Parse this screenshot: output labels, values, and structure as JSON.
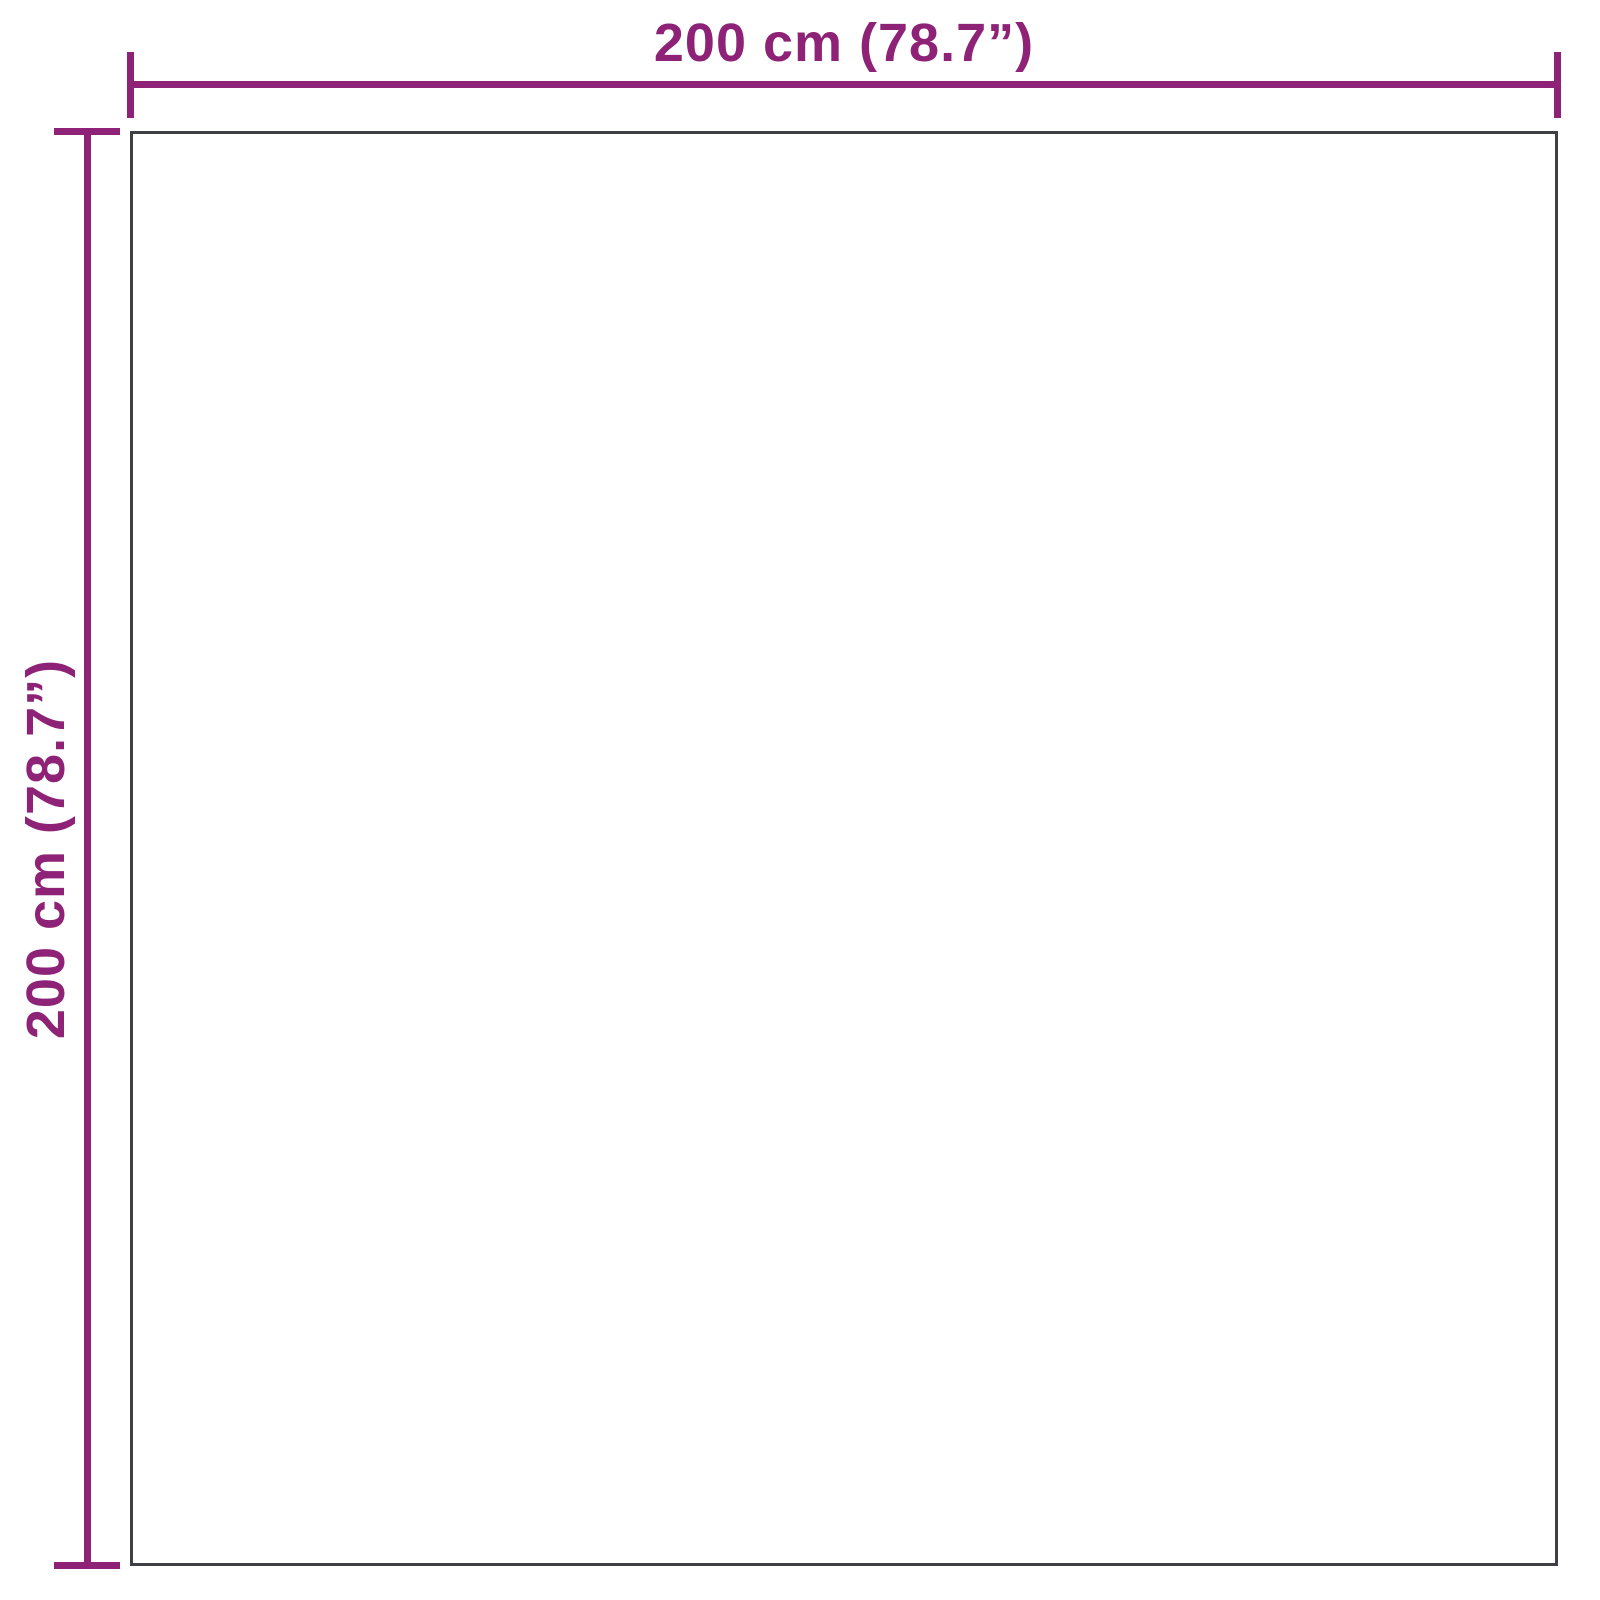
{
  "diagram": {
    "type": "product-dimension-diagram",
    "shape": "square",
    "labels": {
      "width": "200 cm (78.7”)",
      "height": "200 cm (78.7”)"
    },
    "dimensions": {
      "width_cm": 200,
      "width_in": 78.7,
      "height_cm": 200,
      "height_in": 78.7
    }
  },
  "colors": {
    "dimension": "#8e2277",
    "outline": "#3e4044",
    "background": "#ffffff"
  }
}
